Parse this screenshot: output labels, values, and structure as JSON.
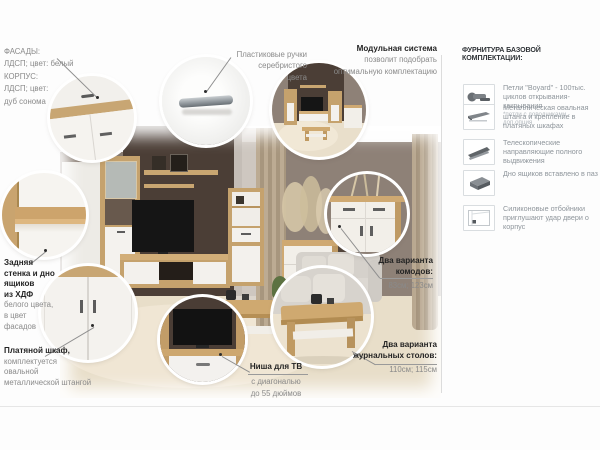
{
  "colors": {
    "accent_wall": "#4b3e36",
    "side_wall": "#8e8177",
    "floor": "#e8dec9",
    "oak_sonoma": "#c5a26d",
    "white_front": "#f3f1ed",
    "callout_text": "#8a8a8a",
    "callout_bold": "#242424",
    "divider": "#dcdcdc"
  },
  "callouts": {
    "facades": {
      "lines": [
        "ФАСАДЫ:",
        "ЛДСП; цвет: белый",
        "КОРПУС:",
        "ЛДСП; цвет:",
        "дуб сонома"
      ]
    },
    "handles": {
      "lines": [
        "Пластиковые ручки",
        "серебристого",
        "цвета"
      ]
    },
    "modular_system": {
      "title": "Модульная система",
      "lines": [
        "позволит подобрать",
        "оптимальную комплектацию"
      ]
    },
    "back_panel": {
      "bold_lines": [
        "Задняя",
        "стенка и дно",
        "ящиков",
        "из ХДФ"
      ],
      "lines": [
        "белого цвета,",
        "в цвет",
        "фасадов"
      ]
    },
    "wardrobe": {
      "title": "Платяной шкаф,",
      "lines": [
        "комплектуется",
        "овальной",
        "металлической штангой"
      ]
    },
    "tv_niche": {
      "title": "Ниша для ТВ",
      "lines": [
        "с диагональю",
        "до 55 дюймов"
      ]
    },
    "commodes": {
      "title_lines": [
        "Два варианта",
        "комодов:"
      ],
      "value": "83см; 123см"
    },
    "coffee_tables": {
      "title_lines": [
        "Два варианта",
        "журнальных столов:"
      ],
      "value": "110см; 115см"
    }
  },
  "hardware_panel": {
    "title": "ФУРНИТУРА БАЗОВОЙ КОМПЛЕКТАЦИИ:",
    "items": [
      {
        "icon": "hinge-icon",
        "text": "Петли \"Boyard\" - 100тыс. циклов открывания-закрывания",
        "note": "*петли с доводчиками - доп.опция"
      },
      {
        "icon": "shelf-rod-icon",
        "text": "Металлическая овальная штанга и крепление в платяных шкафах",
        "note": ""
      },
      {
        "icon": "telescopic-slide-icon",
        "text": "Телескопические направляющие полного выдвижения",
        "note": ""
      },
      {
        "icon": "drawer-bottom-icon",
        "text": "Дно ящиков вставлено в паз",
        "note": ""
      },
      {
        "icon": "silicone-bumper-icon",
        "text": "Силиконовые отбойники приглушают удар двери о корпус",
        "note": ""
      }
    ]
  }
}
